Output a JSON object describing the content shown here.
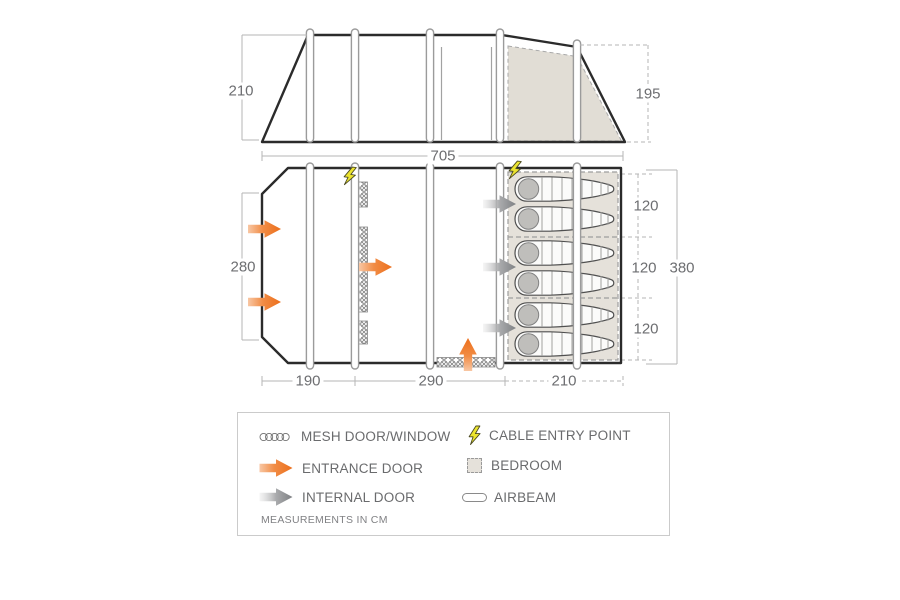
{
  "dimensions": {
    "side_height": "210",
    "rear_height": "195",
    "total_length": "705",
    "front_width": "280",
    "bedroom_depth_total": "380",
    "bedroom_section_1": "120",
    "bedroom_section_2": "120",
    "bedroom_section_3": "120",
    "bottom_porch": "190",
    "bottom_living": "290",
    "bottom_bedroom": "210"
  },
  "legend": {
    "mesh": "MESH DOOR/WINDOW",
    "entrance": "ENTRANCE DOOR",
    "internal": "INTERNAL DOOR",
    "cable": "CABLE ENTRY POINT",
    "bedroom": "BEDROOM",
    "airbeam": "AIRBEAM",
    "note": "MEASUREMENTS IN CM"
  },
  "counts": {
    "airbeams": 5,
    "sleeping_bags": 6,
    "bedroom_compartments": 3
  },
  "colors": {
    "accent_orange": "#ee7420",
    "internal_gray": "#7f8184",
    "cable_yellow": "#ece42f",
    "bedroom_fill": "#e5e1da",
    "outline_dark": "#2b2b2b",
    "dimension_text": "#6d6e71"
  }
}
